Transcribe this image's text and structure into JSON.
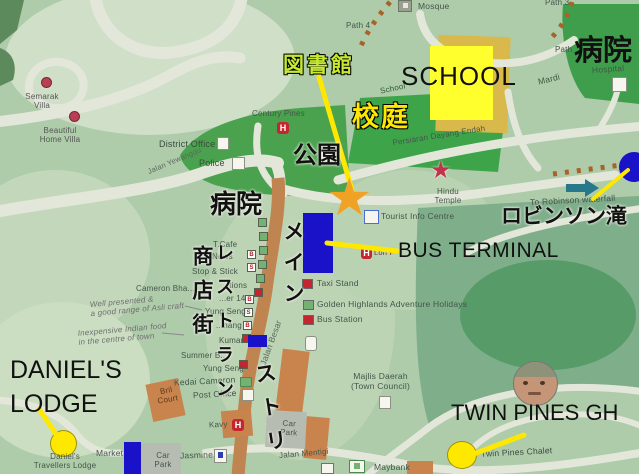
{
  "annotations": {
    "library_jp": "図書館",
    "schoolyard_jp": "校庭",
    "park_jp": "公園",
    "hospital_town_jp": "病院",
    "hospital_ne_jp": "病院",
    "shopping_street_jp": "商店街",
    "restaurant_jp": "レストラン",
    "main_street_jp_1": "メイン",
    "main_street_jp_2": "ストリ",
    "robinson_falls_jp": "ロビンソン滝",
    "school_en": "SCHOOL",
    "bus_terminal_en": "BUS TERMINAL",
    "daniels_lodge_line1": "DANIEL'S",
    "daniels_lodge_line2": "LODGE",
    "twin_pines_en": "TWIN PINES GH"
  },
  "map_labels": {
    "semarak_villa": "Semarak\nVilla",
    "beautiful_home_villa": "Beautiful\nHome Villa",
    "century_pines": "Century Pines",
    "district_office": "District Office",
    "police": "Police",
    "mosque": "Mosque",
    "path_4": "Path 4",
    "path_3": "Path 3",
    "path_r": "Path",
    "hospital": "Hospital",
    "mardi": "Mardi",
    "persiaran_dayang_endah": "Persiaran Dayang Endah",
    "hindu_temple": "Hindu\nTemple",
    "tourist_info_centre": "Tourist Info Centre",
    "loh": "Loh P",
    "school_small": "School",
    "jalan_yewangqu": "Jalan Yewangqu",
    "jalan_besar": "Jalan Besar",
    "t_cafe": "T.Cafe",
    "news": "News",
    "stop_stick": "Stop & Stick",
    "tions": "...tions",
    "er_14": "...er 14",
    "yung_seng": "Yung Seng",
    "hang": "...hang",
    "kumar": "Kumar",
    "summer": "Summer B...",
    "yung_seng_2": "Yung Seng",
    "cameron_bha": "Cameron Bha...",
    "kedai_cameron": "Kedai Cameron",
    "post_office": "Post Office",
    "bril_court": "Bril\nCourt",
    "kavy": "Kavy",
    "market": "Market",
    "daniels_travellers": "Daniel's\nTravellers Lodge",
    "jasmine": "Jasmine",
    "car_park_1": "Car\nPark",
    "car_park_2": "Car\nPark",
    "jalan_mentigi": "Jalan Mentigi",
    "maybank": "Maybank",
    "majlis_daerah": "Majlis Daerah\n(Town Council)",
    "twin_pines_chalet": "Twin Pines Chalet",
    "to_robinson": "To Robinson waterfall"
  },
  "legend": {
    "taxi_stand": "Taxi Stand",
    "golden_highlands": "Golden Highlands Adventure Holidays",
    "bus_station": "Bus Station"
  },
  "notes": {
    "asli_craft": "Well presented &\na good range of Asli craft",
    "indian_food": "Inexpensive Indian food\nin the centre of town"
  },
  "street_boxes": {
    "letters": [
      "B",
      "S",
      "B",
      "S",
      "B"
    ]
  },
  "markers": {
    "h_label": "H"
  },
  "colors": {
    "highlight_yellow": "#ffe800",
    "library_label_green": "#c6e932",
    "marker_blue": "#1a12c8",
    "star_orange": "#f0a224",
    "field_green": "#3fa04b",
    "street_tan": "#bf8450"
  }
}
